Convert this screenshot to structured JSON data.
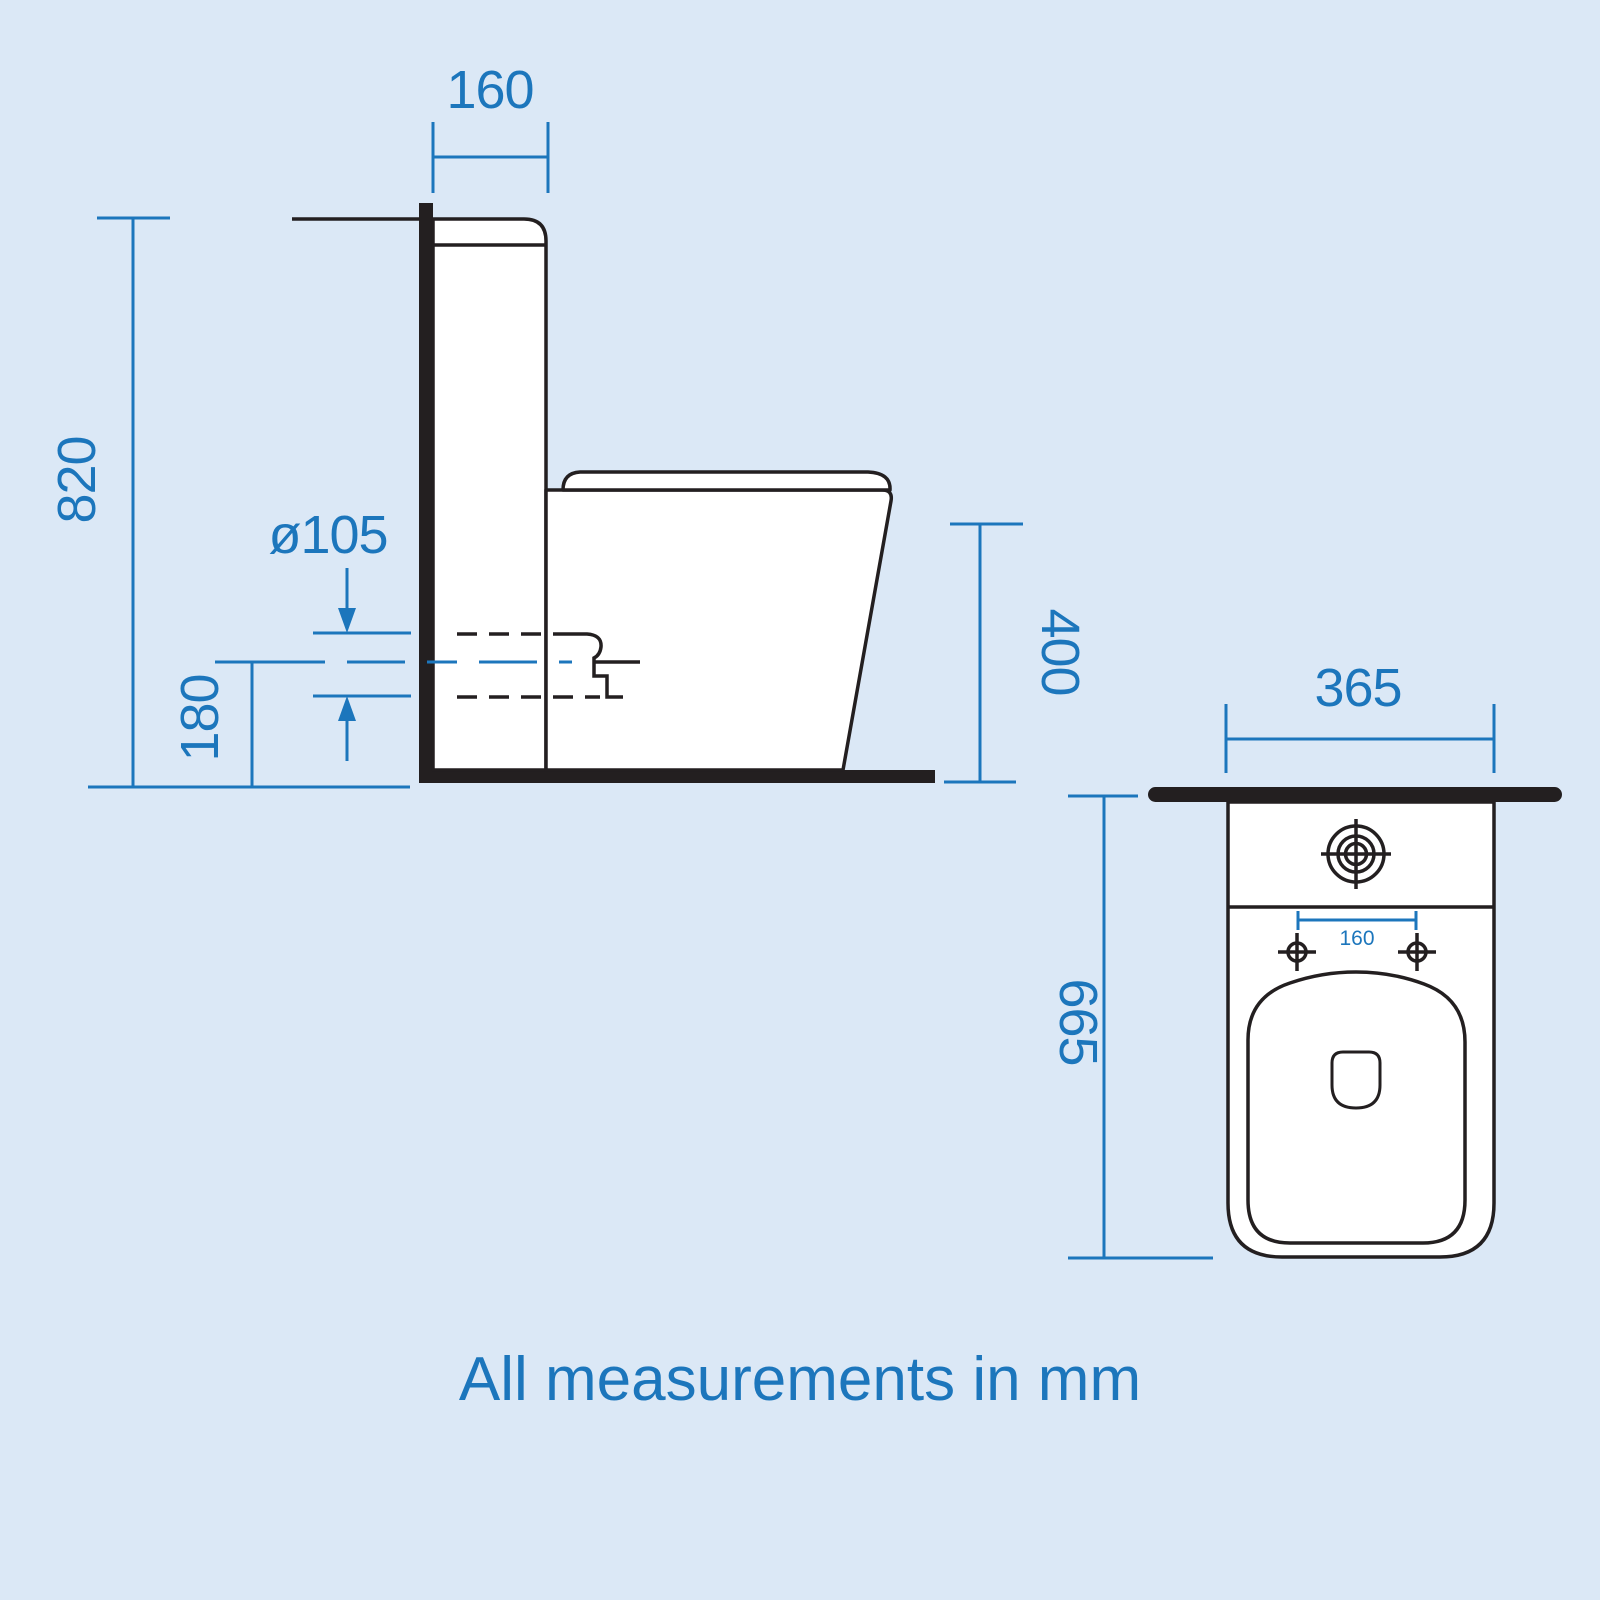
{
  "caption": "All measurements in mm",
  "colors": {
    "accent_blue": "#1c76bc",
    "line_dark": "#231f20",
    "background": "#dbe8f6",
    "fill_white": "#ffffff"
  },
  "side_view": {
    "cistern_depth_label": "160",
    "total_height_label": "820",
    "outlet_diameter_label": "ø105",
    "outlet_centre_height_label": "180",
    "pan_height_label": "400"
  },
  "top_view": {
    "pan_width_label": "365",
    "fixing_hole_spacing_label": "160",
    "pan_depth_label": "665"
  }
}
